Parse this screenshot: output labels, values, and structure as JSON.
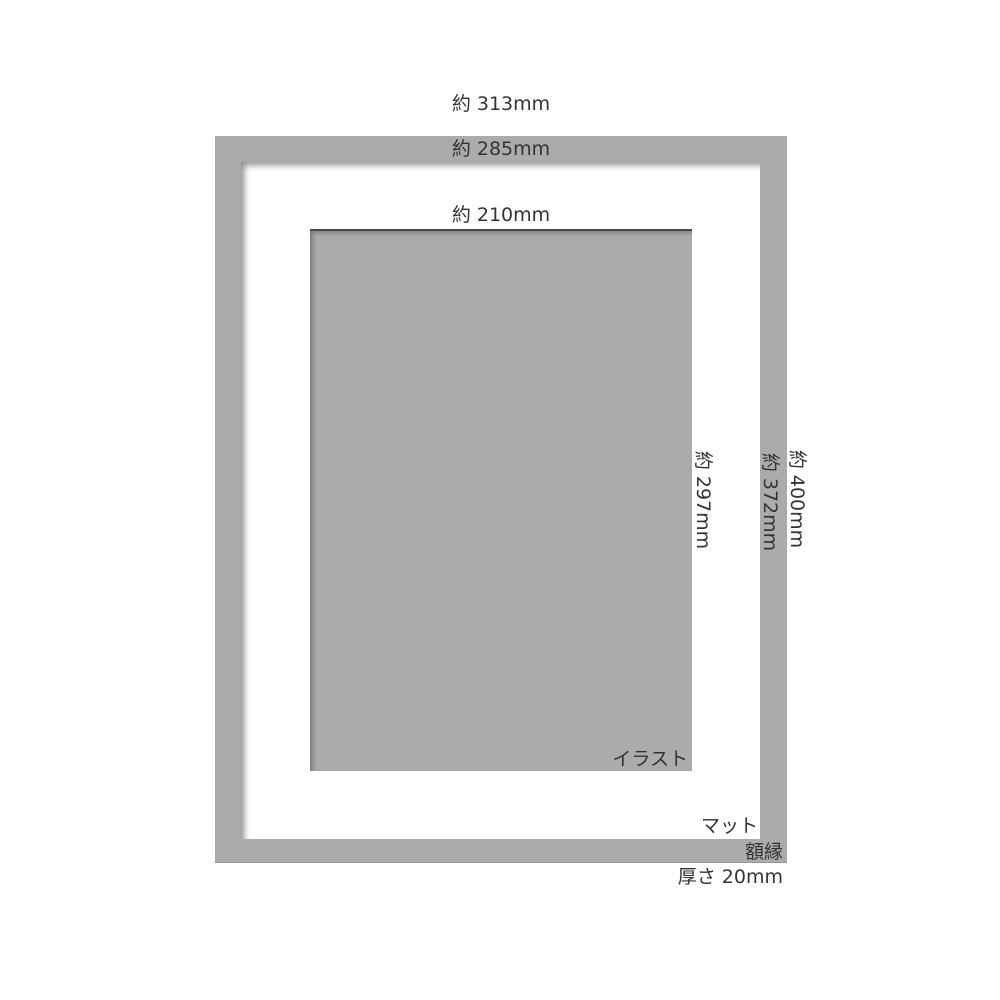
{
  "diagram": {
    "labels": {
      "outer_width": "約 313mm",
      "mat_width": "約 285mm",
      "illustration_width": "約 210mm",
      "illustration_height": "約 297mm",
      "mat_height": "約 372mm",
      "outer_height": "約 400mm",
      "illustration": "イラスト",
      "mat": "マット",
      "frame": "額縁",
      "thickness": "厚さ 20mm"
    },
    "colors": {
      "frame_gray": "#ababab",
      "illustration_gray": "#ababab",
      "mat_white": "#ffffff",
      "text": "#333333",
      "illustration_edge": "#4a4a4a"
    }
  }
}
